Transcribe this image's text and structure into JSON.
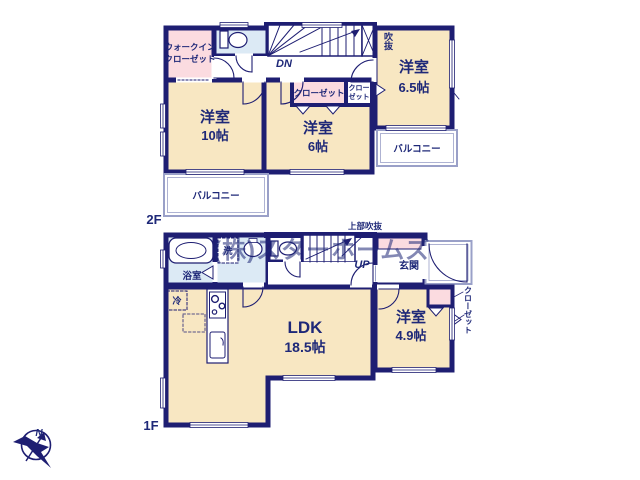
{
  "plan_title": "2-story house floor plan",
  "watermark": "(株)スターホームズ",
  "compass": {
    "north": "N"
  },
  "colors": {
    "wall": "#1e1e72",
    "room_beige": "#f8e7c2",
    "closet_pink": "#fbdbe0",
    "wet_blue": "#dceaf5",
    "text_navy": "#1e2878",
    "thin_line": "#9aa0c8"
  },
  "floor2": {
    "label": "2F",
    "walk_in_closet": {
      "line1": "ウォークイン",
      "line2": "クローゼット"
    },
    "stairs": "DN",
    "void": "吹抜",
    "room10": {
      "name": "洋室",
      "size": "10帖"
    },
    "room6": {
      "name": "洋室",
      "size": "6帖"
    },
    "room65": {
      "name": "洋室",
      "size": "6.5帖"
    },
    "closet_main": "クローゼット",
    "closet_small": {
      "line1": "クロー",
      "line2": "ゼット"
    },
    "balcony_left": "バルコニー",
    "balcony_right": "バルコニー"
  },
  "floor1": {
    "label": "1F",
    "bath": "浴室",
    "washer": "洗",
    "fridge": "冷",
    "stairs": "UP",
    "upper_void": "上部吹抜",
    "entrance": "玄関",
    "closet": "クローゼット",
    "ldk": {
      "name": "LDK",
      "size": "18.5帖"
    },
    "room49": {
      "name": "洋室",
      "size": "4.9帖"
    }
  }
}
